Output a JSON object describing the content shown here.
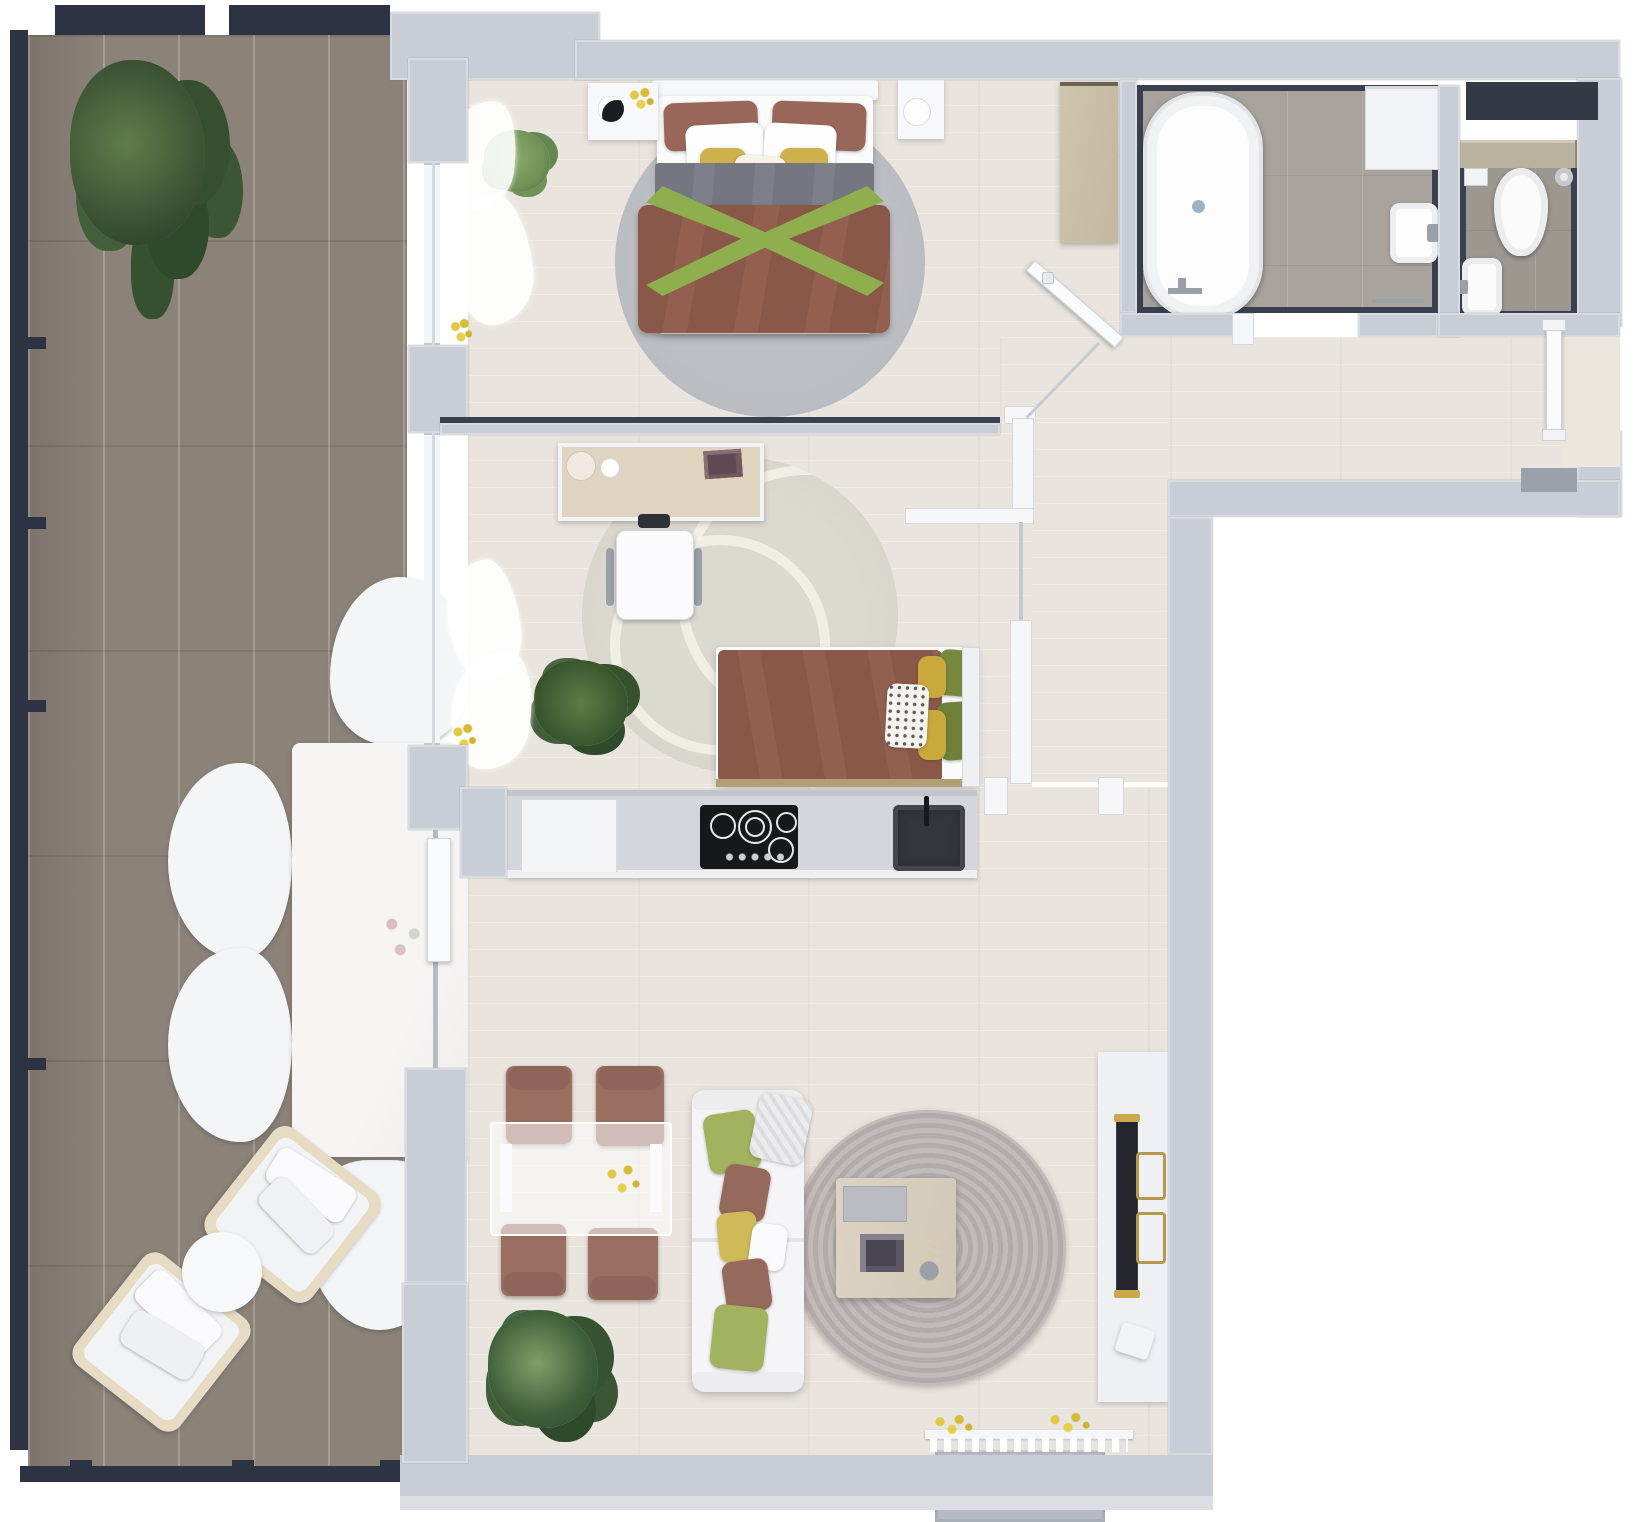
{
  "scene": {
    "type": "apartment-floor-plan-top-view",
    "palette": {
      "wall_light": "#c9cdd5",
      "wall_dark_navy": "#2d3342",
      "balcony_deck": "#8b8278",
      "indoor_floor": "#e9e4dd",
      "bath_tile": "#a8a49d",
      "wc_tile": "#9c978f",
      "furniture_white": "#f7f8fa",
      "wood_light": "#d9cfbc",
      "duvet_brown": "#8a5848",
      "throw_green": "#8fae4e",
      "pillow_yellow": "#cdb24c",
      "pillow_brown": "#99675a",
      "duvet_gray": "#74777f",
      "rug_gray": "#b9bcc0",
      "rug_living": "#b2acaa",
      "chair_brown": "#9a6e60",
      "cooktop_black": "#17181c",
      "sink_dark": "#33363c",
      "tv_dark": "#23262c",
      "accent_gold": "#b59a4e",
      "plant_green_dark": "#3b5233",
      "plant_green_light": "#6f9256"
    },
    "rooms": {
      "balcony": {
        "items": [
          "large-potted-plant",
          "marble-dining-table",
          "six-white-chairs",
          "two-lounge-armchairs",
          "round-side-table",
          "railing"
        ]
      },
      "master_bedroom": {
        "items": [
          "double-bed",
          "gray-round-rug",
          "left-nightstand",
          "right-nightstand",
          "small-plant",
          "sheer-curtains",
          "window-sill-flowers"
        ]
      },
      "second_bedroom": {
        "items": [
          "desk",
          "office-chair",
          "single-bed",
          "patterned-round-rug",
          "palm-plant",
          "sheer-curtains",
          "glass-partition"
        ]
      },
      "hallway": {
        "items": [
          "wood-sideboard",
          "open-bathroom-door",
          "diagonal-glass-screen",
          "entrance-door",
          "entrance-landing",
          "doormat"
        ]
      },
      "bathroom": {
        "items": [
          "freestanding-bathtub",
          "washing-machine",
          "wall-hung-sink",
          "towel-rail"
        ]
      },
      "wc": {
        "items": [
          "vanity-counter",
          "toilet",
          "bidet-sink",
          "toilet-paper-holder",
          "toilet-brush",
          "dark-wardrobe-niche"
        ]
      },
      "kitchen": {
        "items": [
          "counter-run",
          "white-cabinet",
          "induction-cooktop",
          "dark-sink"
        ]
      },
      "living_room": {
        "items": [
          "glass-dining-table",
          "four-brown-chairs",
          "white-sofa-with-cushions",
          "round-braided-rug",
          "coffee-table",
          "tv-sideboard",
          "wall-mounted-tv",
          "floor-plant",
          "juliet-balcony",
          "sheer-curtain"
        ]
      }
    }
  }
}
